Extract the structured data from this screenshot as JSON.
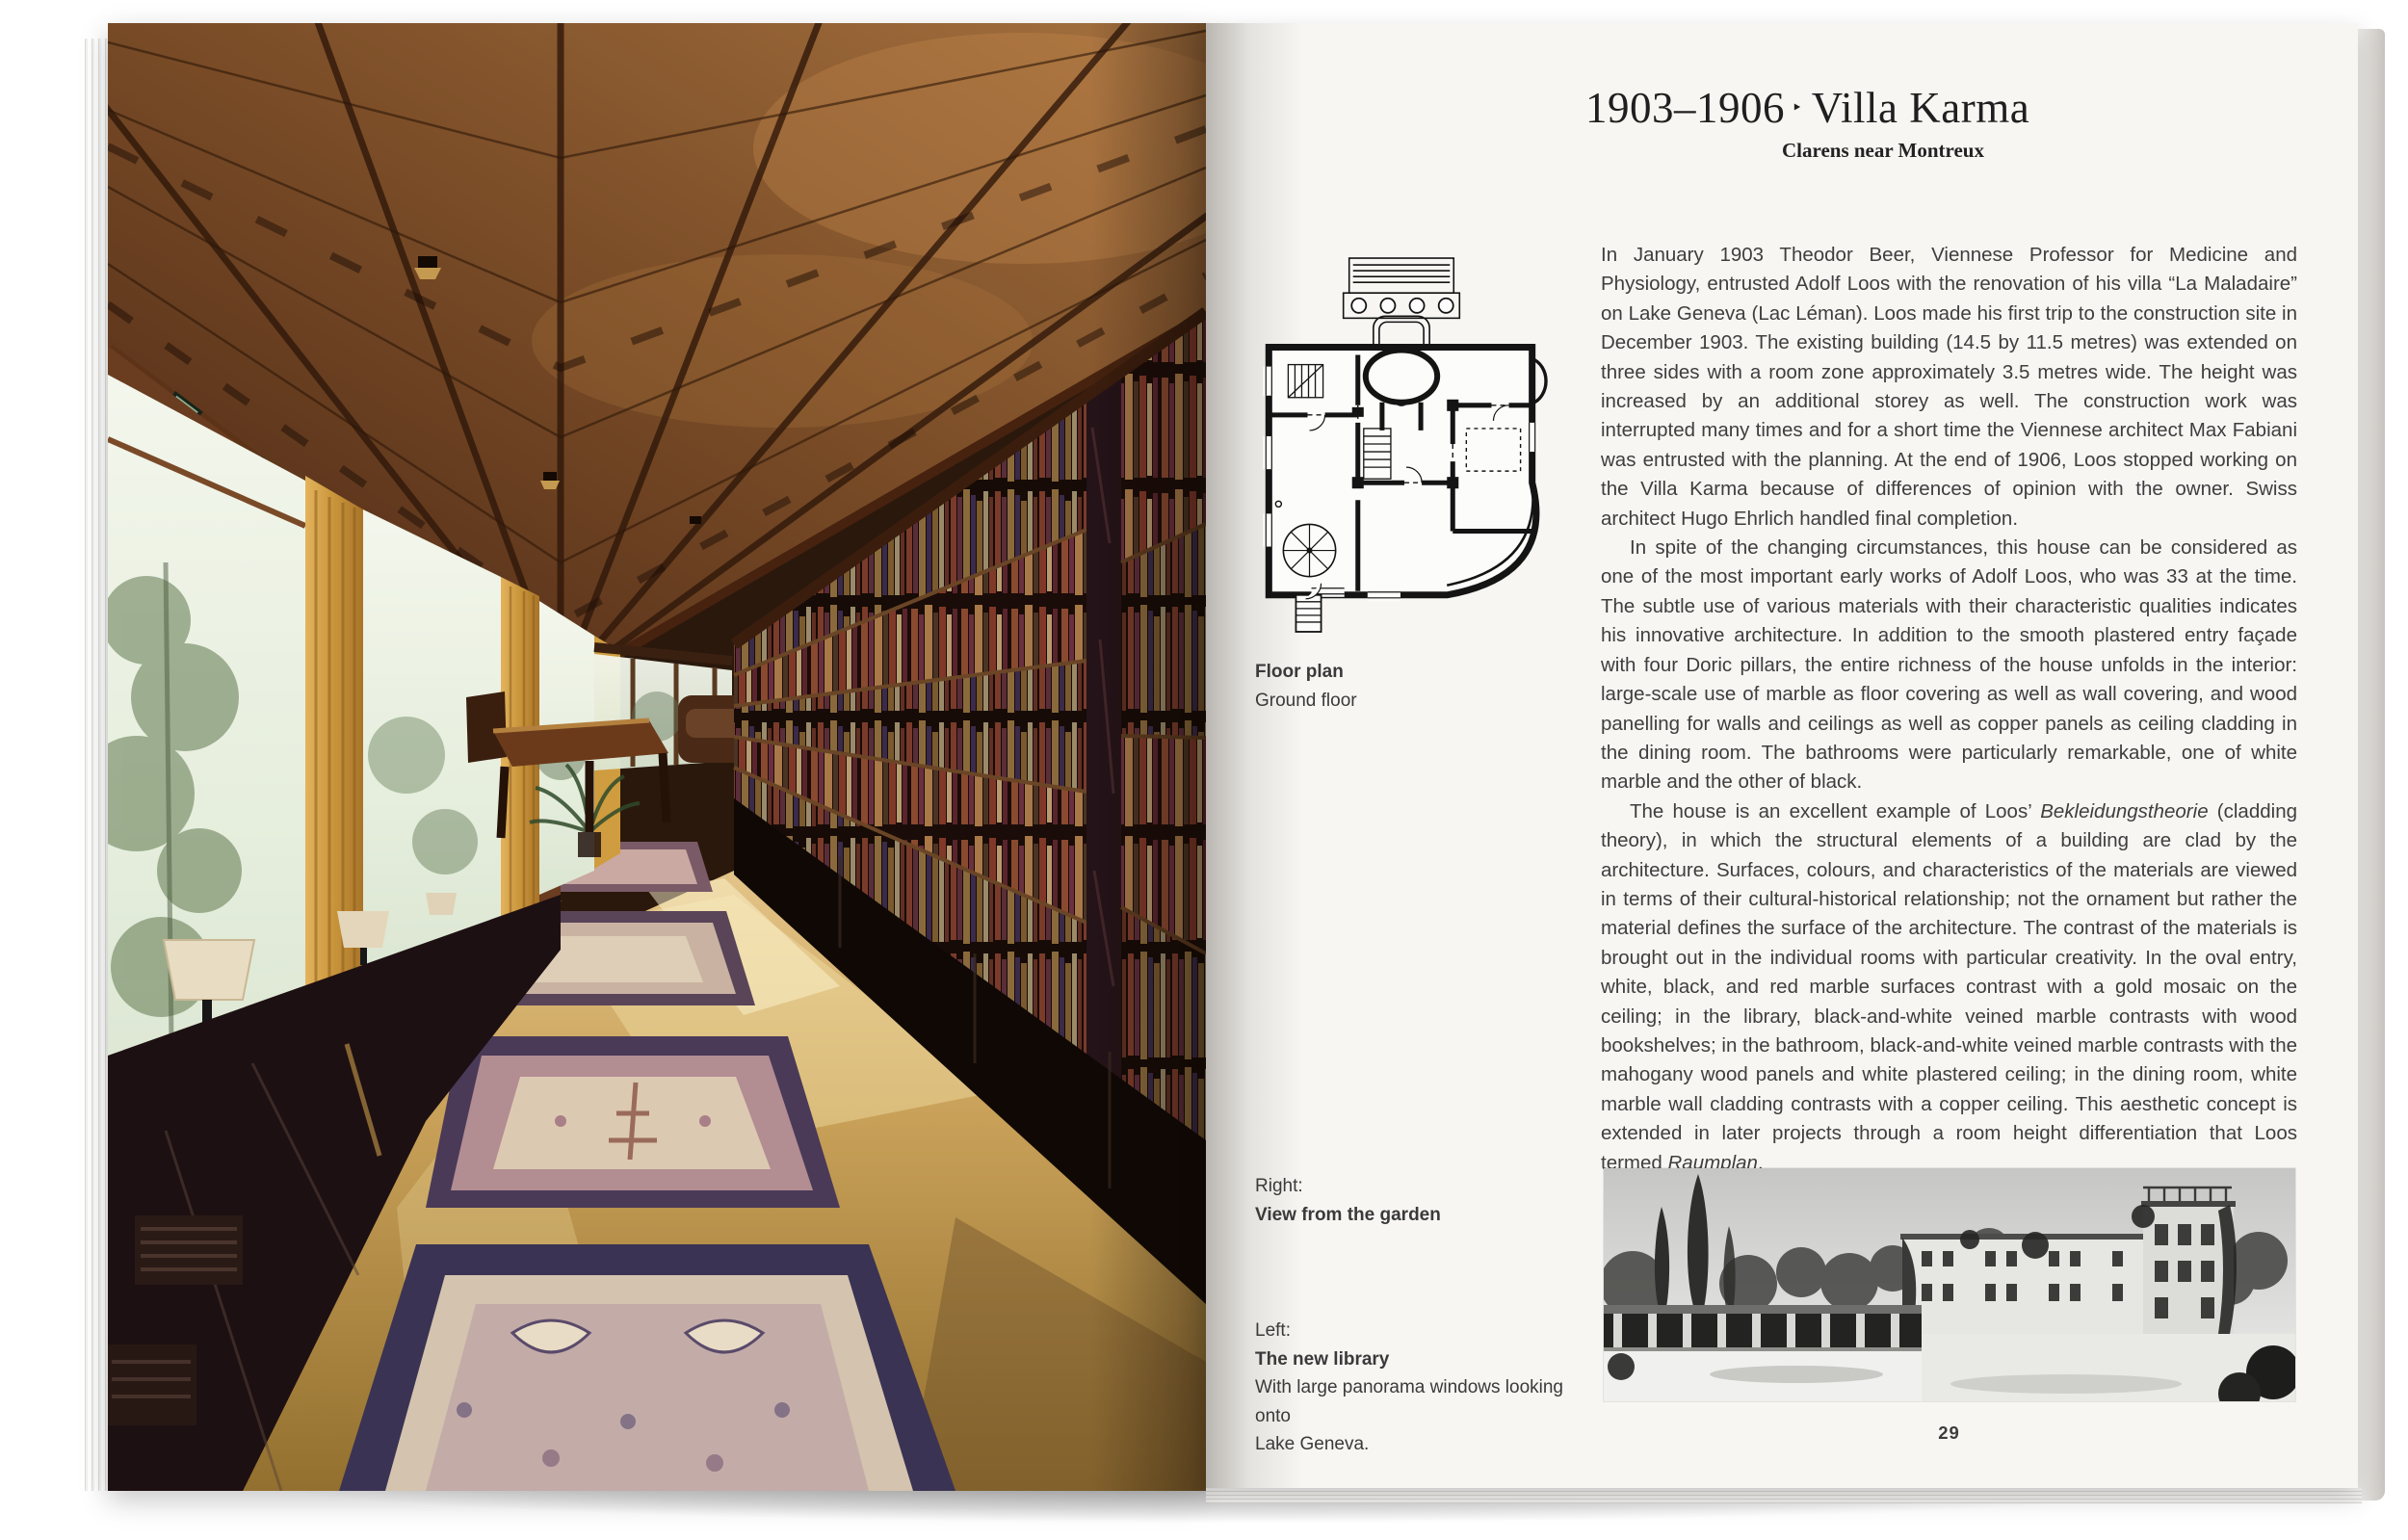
{
  "page": {
    "title": {
      "years": "1903–1906",
      "separator": "‣",
      "name": "Villa Karma",
      "subtitle": "Clarens near Montreux"
    },
    "plan_caption": {
      "title": "Floor plan",
      "subtitle": "Ground floor"
    },
    "body": {
      "p1": "In January 1903 Theodor Beer, Viennese Professor for Medicine and Physiology, entrusted Adolf Loos with the renovation of his villa “La Maladaire” on Lake Geneva (Lac Léman). Loos made his first trip to the construction site in December 1903. The existing building (14.5 by 11.5 metres) was extended on three sides with a room zone approximately 3.5 metres wide. The height was increased by an additional storey as well. The construction work was interrupted many times and for a short time the Viennese architect Max Fabiani was entrusted with the planning. At the end of 1906, Loos stopped working on the Villa Karma because of differences of opinion with the owner. Swiss architect Hugo Ehrlich handled final completion.",
      "p2": "In spite of the changing circumstances, this house can be considered as one of the most important early works of Adolf Loos, who was 33 at the time. The subtle use of various materials with their characteristic qualities indicates his innovative architecture. In addition to the smooth plastered entry façade with four Doric pillars, the entire richness of the house unfolds in the interior: large-scale use of marble as floor covering as well as wall covering, and wood panelling for walls and ceilings as well as copper panels as ceiling cladding in the dining room. The bathrooms were particularly remarkable, one of white marble and the other of black.",
      "p3_seg1": "The house is an excellent example of Loos’ ",
      "p3_italic1": "Bekleidungstheorie",
      "p3_seg2": " (cladding theory), in which the structural elements of a building are clad by the architecture. Surfaces, colours, and characteristics of the materials are viewed in terms of their cultural-historical relationship; not the ornament but rather the material defines the surface of the architecture. The contrast of the materials is brought out in the individual rooms with particular creativity. In the oval entry, white, black, and red marble surfaces contrast with a gold mosaic on the ceiling; in the library, black-and-white veined marble contrasts with wood bookshelves; in the bathroom, black-and-white veined marble contrasts with the mahogany wood panels and white plastered ceiling; in the dining room, white marble wall cladding contrasts with a copper ceiling. This aesthetic concept is extended in later projects through a room height differentiation that Loos termed ",
      "p3_italic2": "Raumplan",
      "p3_seg3": ".",
      "text_color": "#3e3e3e"
    },
    "captions": {
      "right_label": "Right:",
      "right_title": "View from the garden",
      "left_label": "Left:",
      "left_title": "The new library",
      "left_line1": "With large panorama windows looking onto",
      "left_line2": "Lake Geneva."
    },
    "page_number": "29",
    "colors": {
      "page_bg": "#f7f6f3",
      "ceiling_wood": "#8a5a33",
      "curtain_gold": "#d3a14c",
      "window_glass": "#e9f0e2",
      "floor_marble": "#c29a55",
      "rug_mauve": "#b28d92",
      "rug_border": "#4a3a58",
      "shelf_dark": "#190d07"
    }
  }
}
